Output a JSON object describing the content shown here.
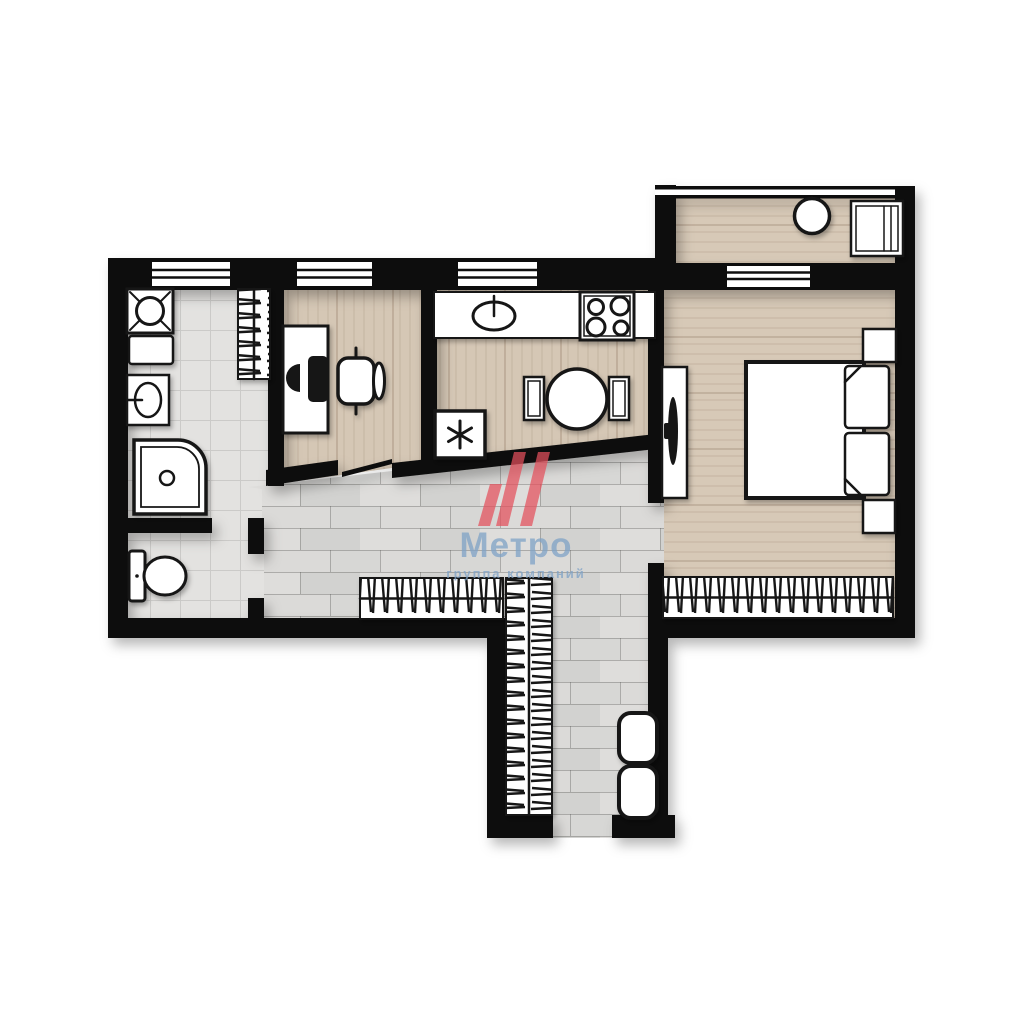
{
  "watermark": {
    "brand": "Метро",
    "tagline": "группа компаний",
    "logo_red": "#E4505C",
    "text_blue": "#7FA3C6"
  },
  "palette": {
    "walls": "#0f0f0f",
    "warm_wood_floor": "#d5c7b5",
    "grey_plank_floor": "#d7d7d5",
    "tile_floor": "#e3e2e0",
    "background": "#ffffff"
  },
  "floorplan": {
    "type": "apartment-floor-plan",
    "rooms": [
      {
        "name": "balcony",
        "floor": "warm-wood",
        "furniture": [
          "round-table",
          "shelving-cabinet"
        ]
      },
      {
        "name": "bedroom",
        "floor": "warm-wood",
        "furniture": [
          "double-bed",
          "pillow",
          "pillow",
          "nightstand",
          "nightstand",
          "tv-stand",
          "wardrobe-with-hangers"
        ]
      },
      {
        "name": "kitchen",
        "floor": "warm-wood",
        "furniture": [
          "counter-with-sink",
          "stove-4-burner",
          "round-dining-table",
          "chair",
          "chair",
          "refrigerator"
        ]
      },
      {
        "name": "study",
        "floor": "warm-wood",
        "furniture": [
          "desk",
          "monitor",
          "office-chair"
        ]
      },
      {
        "name": "bathroom",
        "floor": "tile",
        "furniture": [
          "washing-machine",
          "cabinet",
          "washbasin",
          "shower-tray",
          "drying-rack"
        ]
      },
      {
        "name": "wc",
        "floor": "tile",
        "furniture": [
          "toilet"
        ]
      },
      {
        "name": "hallway",
        "floor": "grey-plank",
        "furniture": [
          "wardrobe-with-hangers"
        ]
      },
      {
        "name": "corridor",
        "floor": "grey-plank",
        "furniture": [
          "wardrobe-with-hangers",
          "pouf",
          "pouf"
        ]
      }
    ],
    "fridge_symbol": "✳",
    "window_count": 5
  }
}
